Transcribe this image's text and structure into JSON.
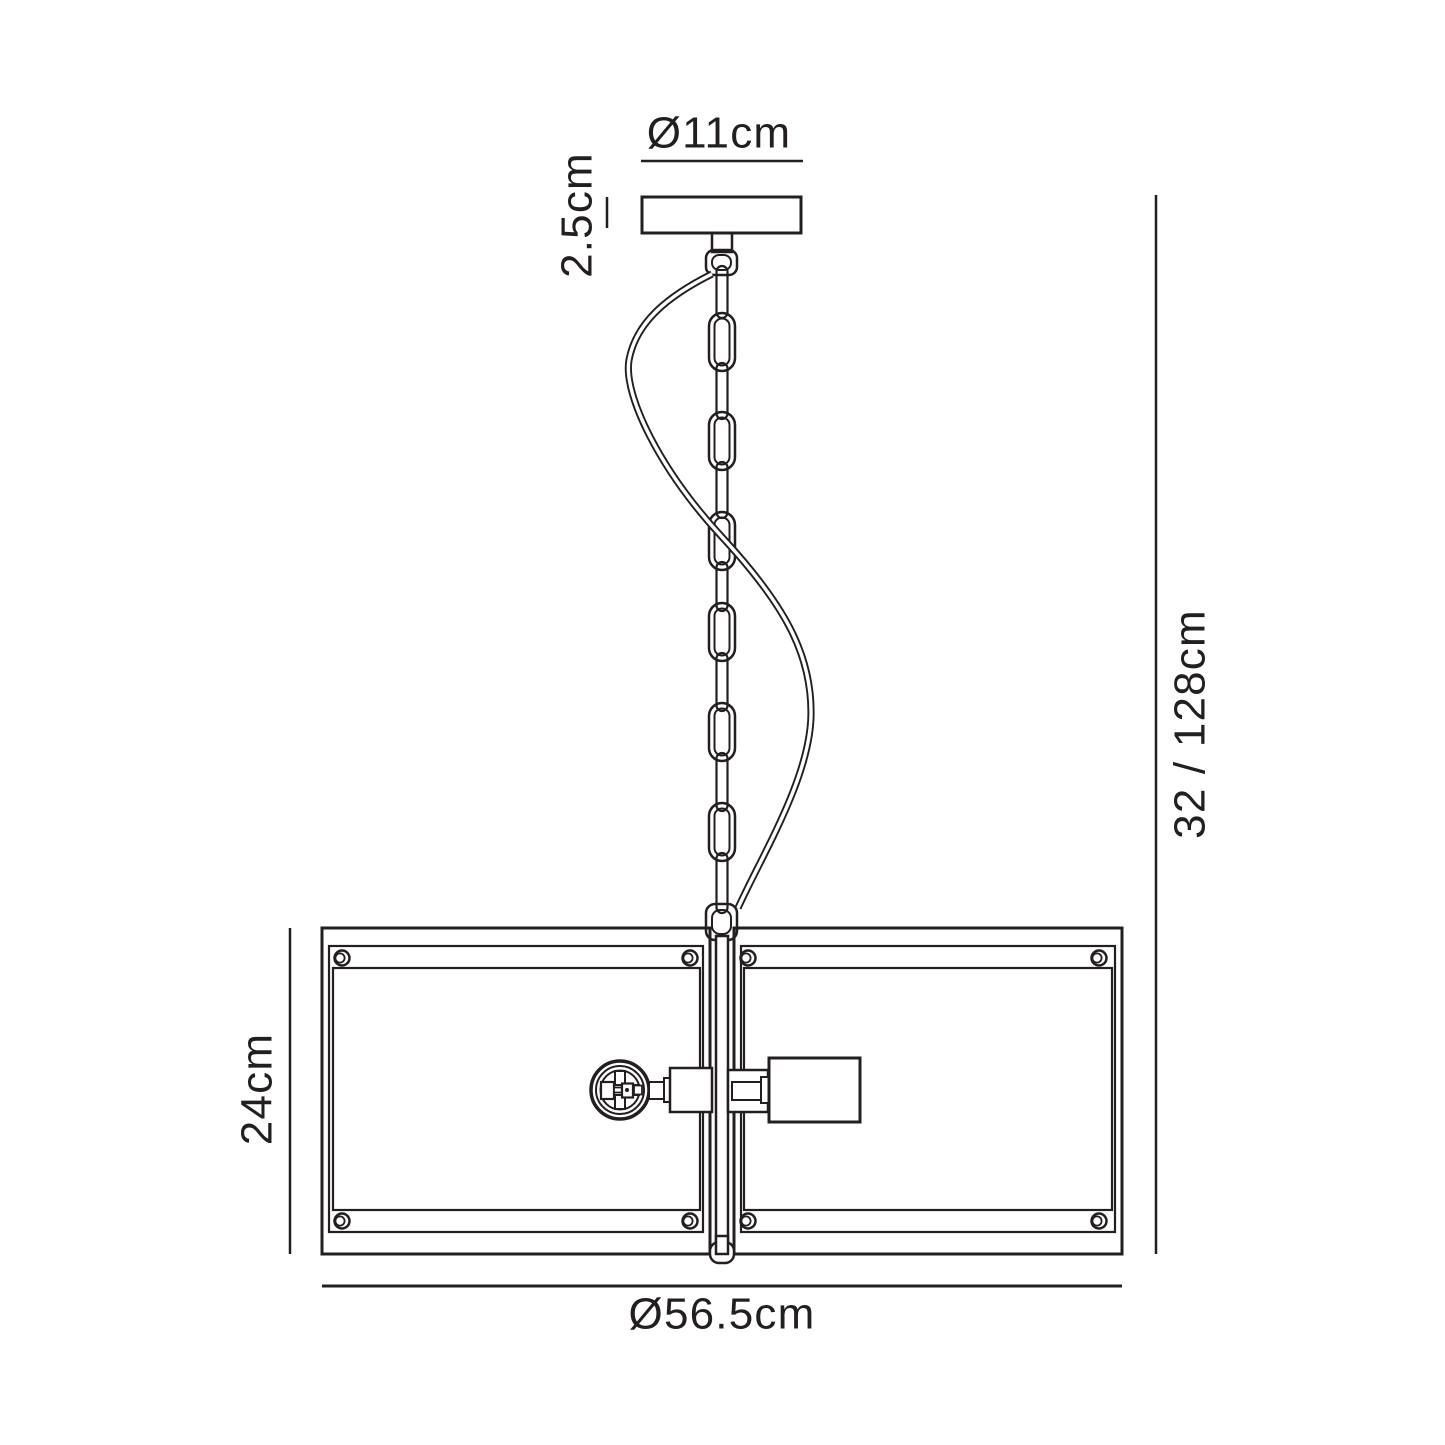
{
  "diagram": {
    "type": "pendant-light-dimension-drawing",
    "labels": {
      "canopy_diameter": "Ø11cm",
      "canopy_height": "2.5cm",
      "shade_height": "24cm",
      "shade_width": "Ø56.5cm",
      "drop_height": "32 / 128cm"
    },
    "colors": {
      "line": "#231f20",
      "background": "#ffffff"
    },
    "chain": {
      "large_link_count": 6
    }
  }
}
